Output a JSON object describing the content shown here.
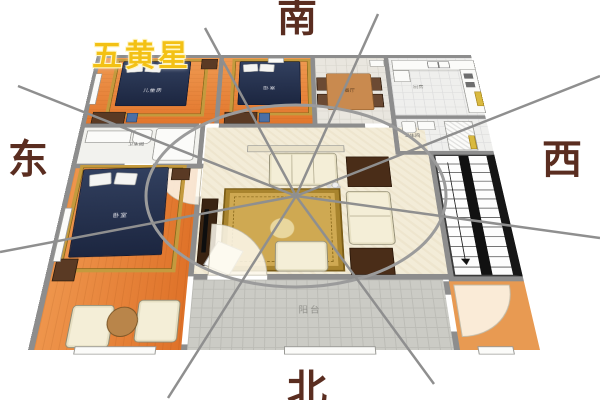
{
  "compass": {
    "south": "南",
    "north": "北",
    "east": "东",
    "west": "西",
    "star_label": "五黄星"
  },
  "rooms": {
    "children_bedroom": "儿童房",
    "bedroom_top": "卧室",
    "master_bedroom": "卧室",
    "bathroom_left": "卫生间",
    "bathroom_right": "卫生间",
    "kitchen": "厨房",
    "dining": "餐厅",
    "balcony": "阳台"
  },
  "colors": {
    "direction_text": "#5a2d20",
    "star_text": "#f3c115",
    "compass_line": "#929292",
    "wall": "#8d8d8d",
    "wood_floor": "#e4813a",
    "living_floor": "#f3ecd8",
    "bed": "#26324e",
    "carpet": "#c9a44e",
    "door_marker": "#d9b93f"
  }
}
